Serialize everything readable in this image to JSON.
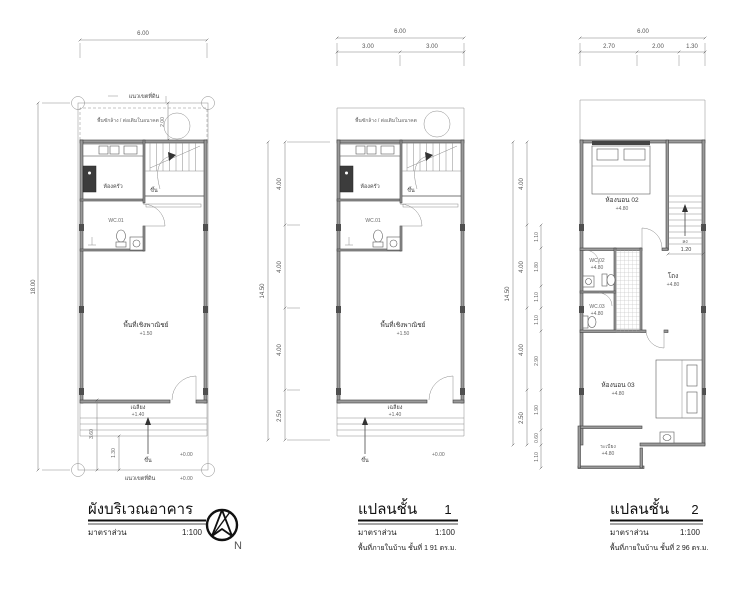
{
  "site_plan": {
    "title": "ผังบริเวณอาคาร",
    "scale_label": "มาตราส่วน",
    "scale_value": "1:100",
    "north_label": "N",
    "dims": {
      "top": "6.00",
      "left": "18.00",
      "wash_depth": "2.00",
      "porch": "3.60",
      "step": "1.30"
    },
    "labels": {
      "boundary": "แนวเขตที่ดิน",
      "wash": "พื้นซักล้าง / ต่อเติมในอนาคต",
      "kitchen": "ห้องครัว",
      "wc01": "WC.01",
      "up": "ขึ้น",
      "commercial": "พื้นที่เชิงพาณิชย์",
      "commercial_level": "+1.50",
      "porch": "เฉลียง",
      "porch_level": "+1.40",
      "entry_up": "ขึ้น",
      "ground_level": "+0.00",
      "ground_level2": "+0.00"
    }
  },
  "floor1": {
    "title": "แปลนชั้น",
    "number": "1",
    "scale_label": "มาตราส่วน",
    "scale_value": "1:100",
    "area_note": "พื้นที่ภายในบ้าน ชั้นที่ 1    91 ตร.ม.",
    "dims": {
      "top": "6.00",
      "top_a": "3.00",
      "top_b": "3.00",
      "left_total": "14.50",
      "left_a": "4.00",
      "left_b": "4.00",
      "left_c": "4.00",
      "left_d": "2.50"
    },
    "labels": {
      "wash": "พื้นซักล้าง / ต่อเติมในอนาคต",
      "kitchen": "ห้องครัว",
      "wc01": "WC.01",
      "up": "ขึ้น",
      "commercial": "พื้นที่เชิงพาณิชย์",
      "commercial_level": "+1.50",
      "porch": "เฉลียง",
      "porch_level": "+1.40",
      "entry_up": "ขึ้น",
      "ground_level": "+0.00"
    }
  },
  "floor2": {
    "title": "แปลนชั้น",
    "number": "2",
    "scale_label": "มาตราส่วน",
    "scale_value": "1:100",
    "area_note": "พื้นที่ภายในบ้าน ชั้นที่ 2    96 ตร.ม.",
    "dims": {
      "top": "6.00",
      "top_a": "2.70",
      "top_b": "2.00",
      "top_c": "1.30",
      "left_total": "14.50",
      "left_a": "4.00",
      "left_b": "4.00",
      "left_c": "4.00",
      "left_d": "2.50",
      "inner": [
        "1.10",
        "1.80",
        "1.10",
        "1.10",
        "2.90",
        "1.90",
        "0.60",
        "1.10"
      ],
      "stair_width": "1.20"
    },
    "labels": {
      "bedroom2": "ห้องนอน 02",
      "bedroom2_level": "+4.80",
      "wc02": "WC.02",
      "wc02_level": "+4.80",
      "wc03": "WC.03",
      "wc03_level": "+4.80",
      "hall": "โถง",
      "hall_level": "+4.80",
      "bedroom3": "ห้องนอน 03",
      "bedroom3_level": "+4.80",
      "balcony": "ระเบียง",
      "balcony_level": "+4.80",
      "down": "ลง"
    }
  }
}
